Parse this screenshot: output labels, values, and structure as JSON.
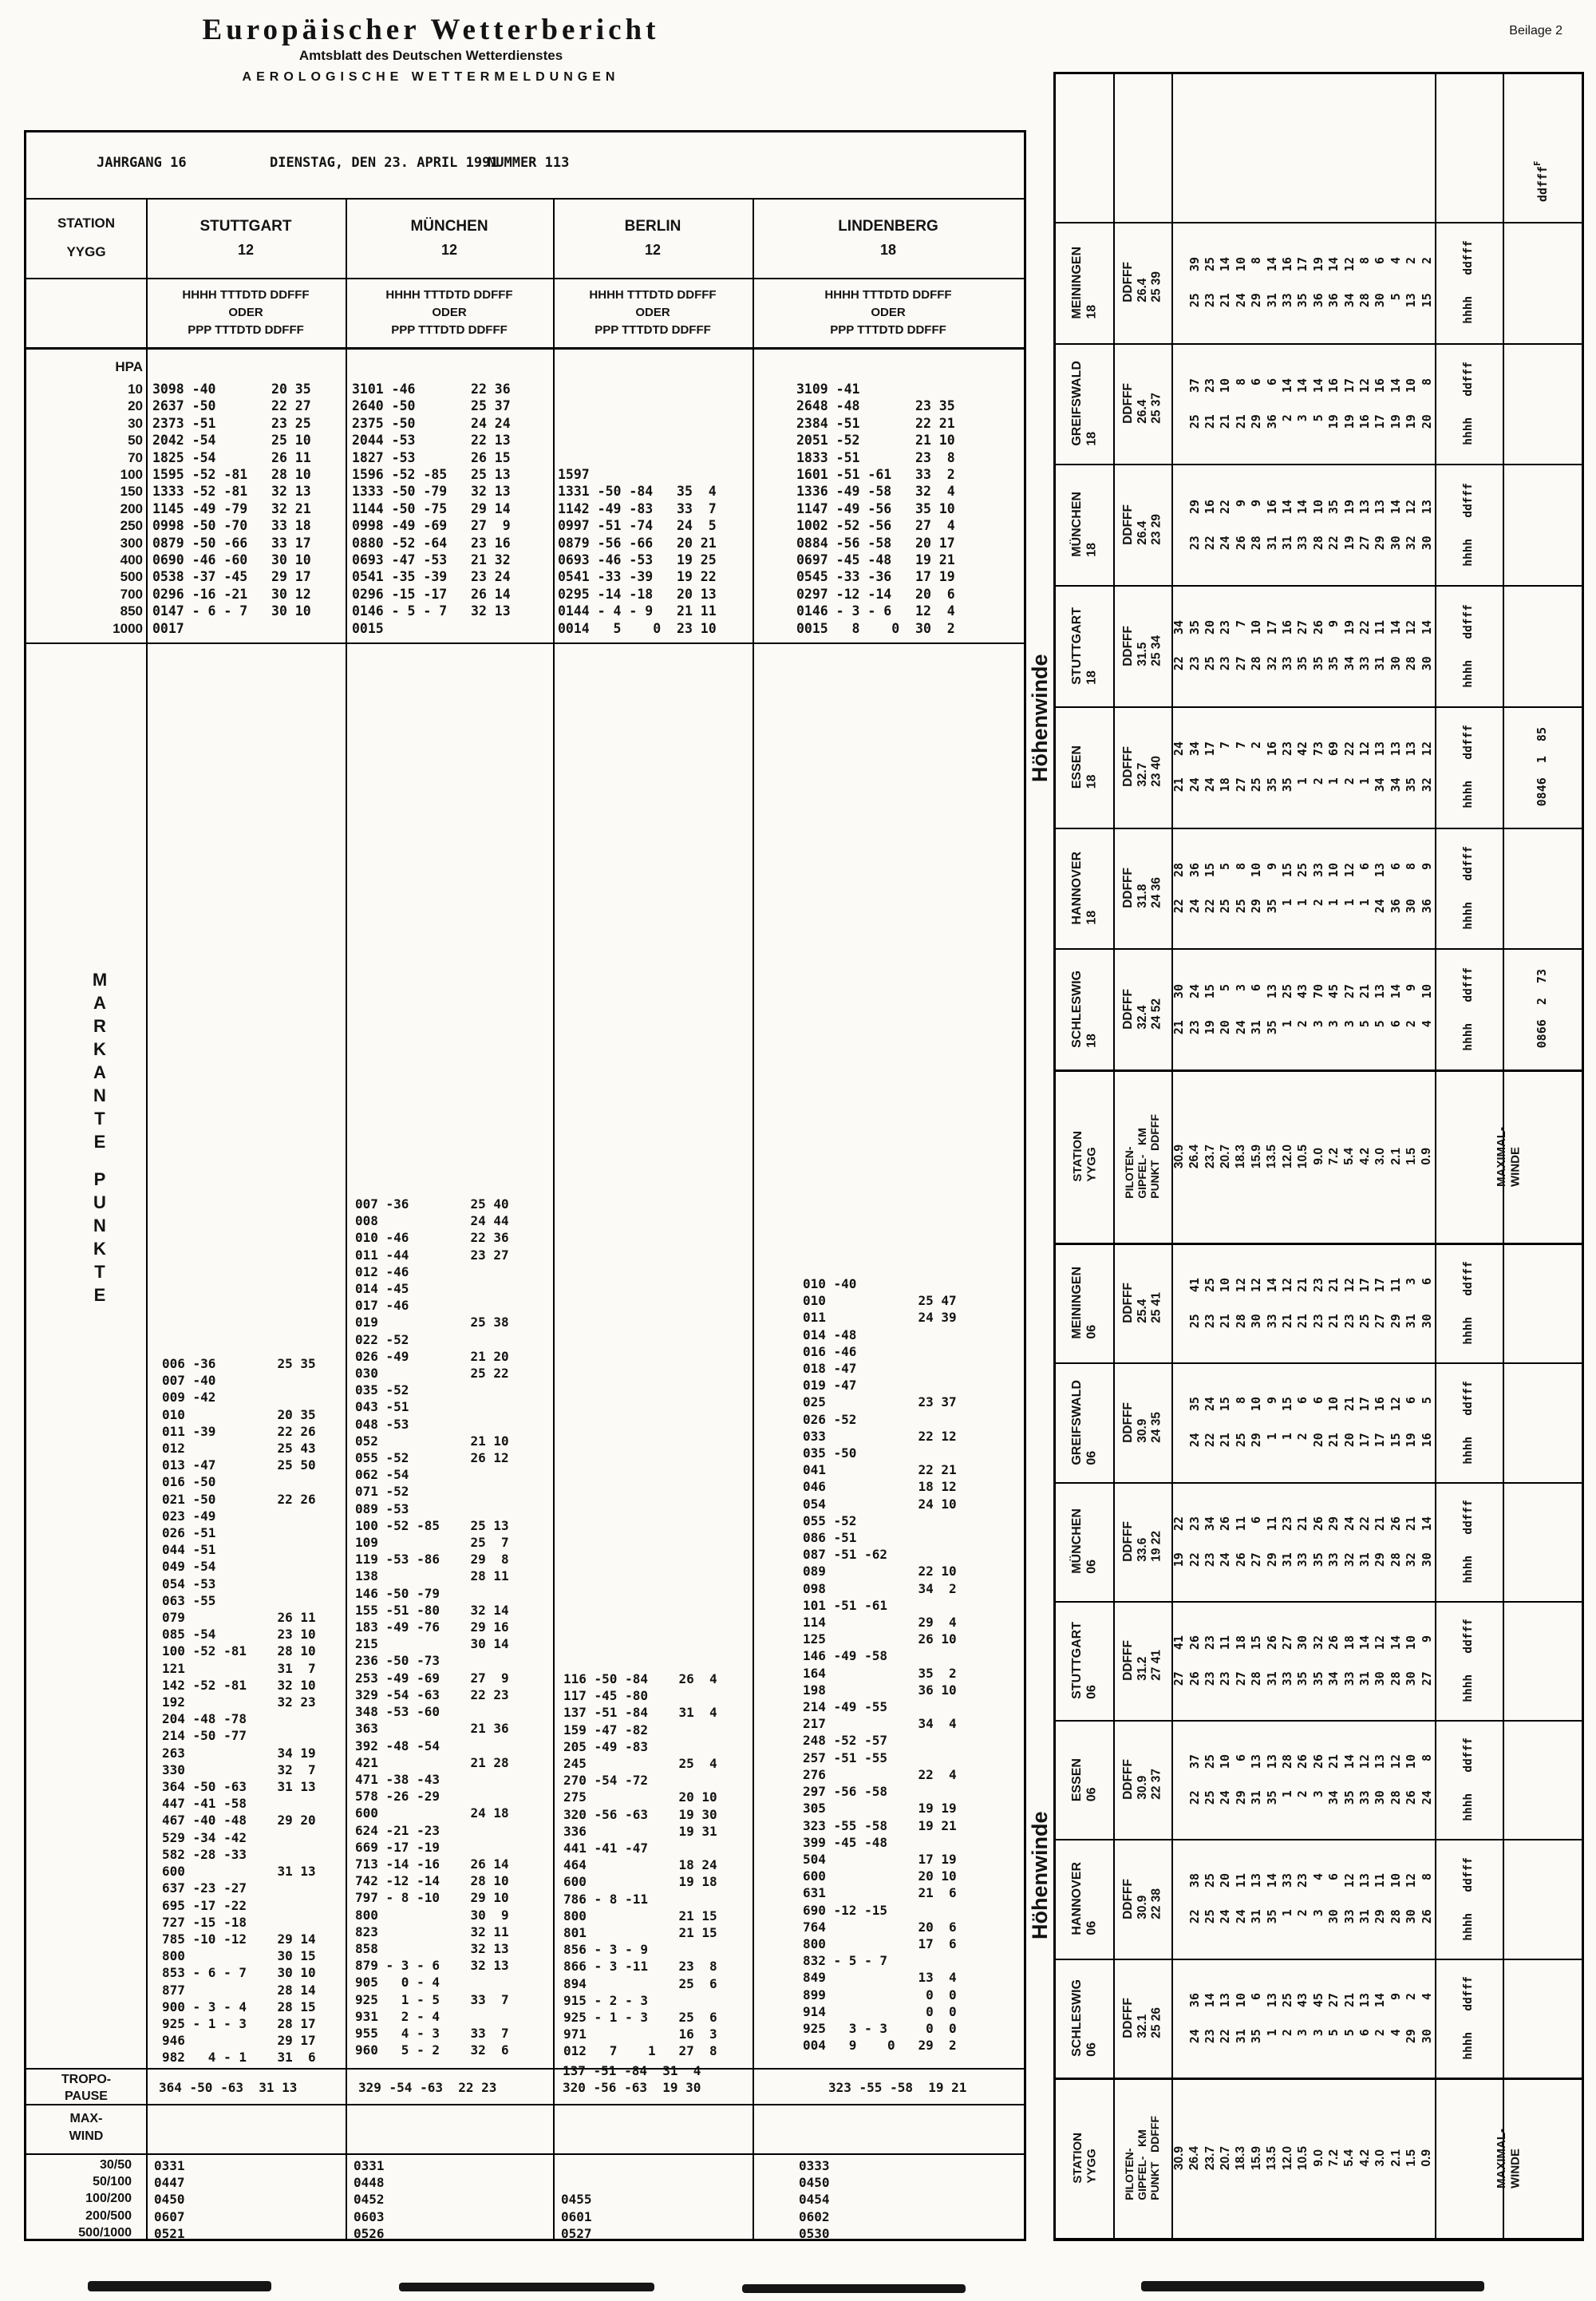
{
  "page": {
    "title": "Europäischer Wetterbericht",
    "subtitle": "Amtsblatt des Deutschen Wetterdienstes",
    "section": "AEROLOGISCHE WETTERMELDUNGEN",
    "corner": "Beilage 2"
  },
  "info": {
    "jahrgang": "JAHRGANG 16",
    "datum": "DIENSTAG, DEN 23. APRIL 1991",
    "nummer": "NUMMER 113"
  },
  "main_table": {
    "label_header": {
      "station": "STATION",
      "yygg": "YYGG",
      "hpa": "HPA"
    },
    "col_header": [
      "HHHH  TTTDTD  DDFFF",
      "ODER",
      "PPP  TTTDTD  DDFFF"
    ],
    "pressures": [
      "10",
      "20",
      "30",
      "50",
      "70",
      "100",
      "150",
      "200",
      "250",
      "300",
      "400",
      "500",
      "700",
      "850",
      "1000"
    ],
    "markante_label": "MARKANTE PUNKTE",
    "tropo_label": [
      "TROPO-",
      "PAUSE"
    ],
    "maxwind_label": [
      "MAX-",
      "WIND"
    ],
    "maxwind_rows": [
      "30/50",
      "50/100",
      "100/200",
      "200/500",
      "500/1000"
    ],
    "stations": [
      {
        "name": "STUTTGART",
        "yygg": "12",
        "hpa_rows": [
          "3098 -40       20 35",
          "2637 -50       22 27",
          "2373 -51       23 25",
          "2042 -54       25 10",
          "1825 -54       26 11",
          "1595 -52 -81   28 10",
          "1333 -52 -81   32 13",
          "1145 -49 -79   32 21",
          "0998 -50 -70   33 18",
          "0879 -50 -66   33 17",
          "0690 -46 -60   30 10",
          "0538 -37 -45   29 17",
          "0296 -16 -21   30 12",
          "0147 - 6 - 7   30 10",
          "0017"
        ],
        "markante": [
          "006 -36        25 35",
          "007 -40",
          "009 -42",
          "010            20 35",
          "011 -39        22 26",
          "012            25 43",
          "013 -47        25 50",
          "016 -50",
          "021 -50        22 26",
          "023 -49",
          "026 -51",
          "044 -51",
          "049 -54",
          "054 -53",
          "063 -55",
          "079            26 11",
          "085 -54        23 10",
          "100 -52 -81    28 10",
          "121            31  7",
          "142 -52 -81    32 10",
          "192            32 23",
          "204 -48 -78",
          "214 -50 -77",
          "263            34 19",
          "330            32  7",
          "364 -50 -63    31 13",
          "447 -41 -58",
          "467 -40 -48    29 20",
          "529 -34 -42",
          "582 -28 -33",
          "600            31 13",
          "637 -23 -27",
          "695 -17 -22",
          "727 -15 -18",
          "785 -10 -12    29 14",
          "800            30 15",
          "853 - 6 - 7    30 10",
          "877            28 14",
          "900 - 3 - 4    28 15",
          "925 - 1 - 3    28 17",
          "946            29 17",
          "982   4 - 1    31  6"
        ],
        "tropopause": [
          "364 -50 -63  31 13"
        ],
        "maxwind": [
          "0331",
          "0447",
          "0450",
          "0607",
          "0521"
        ]
      },
      {
        "name": "MÜNCHEN",
        "yygg": "12",
        "hpa_rows": [
          "3101 -46       22 36",
          "2640 -50       25 37",
          "2375 -50       24 24",
          "2044 -53       22 13",
          "1827 -53       26 15",
          "1596 -52 -85   25 13",
          "1333 -50 -79   32 13",
          "1144 -50 -75   29 14",
          "0998 -49 -69   27  9",
          "0880 -52 -64   23 16",
          "0693 -47 -53   21 32",
          "0541 -35 -39   23 24",
          "0296 -15 -17   26 14",
          "0146 - 5 - 7   32 13",
          "0015"
        ],
        "markante": [
          "007 -36        25 40",
          "008            24 44",
          "010 -46        22 36",
          "011 -44        23 27",
          "012 -46",
          "014 -45",
          "017 -46",
          "019            25 38",
          "022 -52",
          "026 -49        21 20",
          "030            25 22",
          "035 -52",
          "043 -51",
          "048 -53",
          "052            21 10",
          "055 -52        26 12",
          "062 -54",
          "071 -52",
          "089 -53",
          "100 -52 -85    25 13",
          "109            25  7",
          "119 -53 -86    29  8",
          "138            28 11",
          "146 -50 -79",
          "155 -51 -80    32 14",
          "183 -49 -76    29 16",
          "215            30 14",
          "236 -50 -73",
          "253 -49 -69    27  9",
          "329 -54 -63    22 23",
          "348 -53 -60",
          "363            21 36",
          "392 -48 -54",
          "421            21 28",
          "471 -38 -43",
          "578 -26 -29",
          "600            24 18",
          "624 -21 -23",
          "669 -17 -19",
          "713 -14 -16    26 14",
          "742 -12 -14    28 10",
          "797 - 8 -10    29 10",
          "800            30  9",
          "823            32 11",
          "858            32 13",
          "879 - 3 - 6    32 13",
          "905   0 - 4",
          "925   1 - 5    33  7",
          "931   2 - 4",
          "955   4 - 3    33  7",
          "960   5 - 2    32  6"
        ],
        "tropopause": [
          "329 -54 -63  22 23"
        ],
        "maxwind": [
          "0331",
          "0448",
          "0452",
          "0603",
          "0526"
        ]
      },
      {
        "name": "BERLIN",
        "yygg": "12",
        "hpa_rows": [
          "",
          "",
          "",
          "",
          "",
          "1597",
          "1331 -50 -84   35  4",
          "1142 -49 -83   33  7",
          "0997 -51 -74   24  5",
          "0879 -56 -66   20 21",
          "0693 -46 -53   19 25",
          "0541 -33 -39   19 22",
          "0295 -14 -18   20 13",
          "0144 - 4 - 9   21 11",
          "0014   5    0  23 10"
        ],
        "markante": [
          "116 -50 -84    26  4",
          "117 -45 -80",
          "137 -51 -84    31  4",
          "159 -47 -82",
          "205 -49 -83",
          "245            25  4",
          "270 -54 -72",
          "275            20 10",
          "320 -56 -63    19 30",
          "336            19 31",
          "441 -41 -47",
          "464            18 24",
          "600            19 18",
          "786 - 8 -11",
          "800            21 15",
          "801            21 15",
          "856 - 3 - 9",
          "866 - 3 -11    23  8",
          "894            25  6",
          "915 - 2 - 3",
          "925 - 1 - 3    25  6",
          "971            16  3",
          "012   7    1   27  8"
        ],
        "tropopause": [
          "137 -51 -84  31  4",
          "320 -56 -63  19 30"
        ],
        "maxwind": [
          "",
          "",
          "0455",
          "0601",
          "0527"
        ]
      },
      {
        "name": "LINDENBERG",
        "yygg": "18",
        "hpa_rows": [
          "3109 -41",
          "2648 -48       23 35",
          "2384 -51       22 21",
          "2051 -52       21 10",
          "1833 -51       23  8",
          "1601 -51 -61   33  2",
          "1336 -49 -58   32  4",
          "1147 -49 -56   35 10",
          "1002 -52 -56   27  4",
          "0884 -56 -58   20 17",
          "0697 -45 -48   19 21",
          "0545 -33 -36   17 19",
          "0297 -12 -14   20  6",
          "0146 - 3 - 6   12  4",
          "0015   8    0  30  2"
        ],
        "markante": [
          "010 -40",
          "010            25 47",
          "011            24 39",
          "014 -48",
          "016 -46",
          "018 -47",
          "019 -47",
          "025            23 37",
          "026 -52",
          "033            22 12",
          "035 -50",
          "041            22 21",
          "046            18 12",
          "054            24 10",
          "055 -52",
          "086 -51",
          "087 -51 -62",
          "089            22 10",
          "098            34  2",
          "101 -51 -61",
          "114            29  4",
          "125            26 10",
          "146 -49 -58",
          "164            35  2",
          "198            36 10",
          "214 -49 -55",
          "217            34  4",
          "248 -52 -57",
          "257 -51 -55",
          "276            22  4",
          "297 -56 -58",
          "305            19 19",
          "323 -55 -58    19 21",
          "399 -45 -48",
          "504            17 19",
          "600            20 10",
          "631            21  6",
          "690 -12 -15",
          "764            20  6",
          "800            17  6",
          "832 - 5 - 7",
          "849            13  4",
          "899             0  0",
          "914             0  0",
          "925   3 - 3     0  0",
          "004   9    0   29  2"
        ],
        "tropopause": [
          "323 -55 -58  19 21"
        ],
        "maxwind": [
          "0333",
          "0450",
          "0454",
          "0602",
          "0530"
        ]
      }
    ]
  },
  "right_panel": {
    "hoehenwinde_label": "Höhenwinde",
    "corner_label": "ddfff",
    "corner_super": "F",
    "col_labels": "hhhh   ddfff",
    "ddfff_label": "DDFFF",
    "header": {
      "station_lines": [
        "STATION",
        "YYGG"
      ],
      "piloten_lines": [
        "PILOTEN-",
        "GIPFEL-   KM",
        "PUNKT   DDFFF"
      ],
      "maximal_lines": [
        "MAXIMAL-",
        "WINDE"
      ]
    },
    "km_values": [
      "30.9",
      "26.4",
      "23.7",
      "20.7",
      "18.3",
      "15.9",
      "13.5",
      "12.0",
      "10.5",
      "9.0",
      "7.2",
      "5.4",
      "4.2",
      "3.0",
      "2.1",
      "1.5",
      "0.9"
    ],
    "sections": [
      {
        "id": "18",
        "stations": [
          {
            "name": "MEININGEN",
            "yygg": "18",
            "gipfel": "26.4",
            "maxw": "25 39",
            "annotation": "",
            "pairs": [
              "",
              "25   39",
              "23   25",
              "21   14",
              "24   10",
              "29    8",
              "31   14",
              "33   16",
              "35   17",
              "36   19",
              "36   14",
              "34   12",
              "28    8",
              "30    6",
              " 5    4",
              "13    2",
              "15    2"
            ]
          },
          {
            "name": "GREIFSWALD",
            "yygg": "18",
            "gipfel": "26.4",
            "maxw": "25 37",
            "annotation": "",
            "pairs": [
              "",
              "25   37",
              "21   23",
              "21   10",
              "21    8",
              "29    6",
              "36    6",
              " 2   14",
              " 3   14",
              " 5   14",
              "19   16",
              "19   17",
              "16   12",
              "17   16",
              "19   14",
              "19   10",
              "20    8"
            ]
          },
          {
            "name": "MÜNCHEN",
            "yygg": "18",
            "gipfel": "26.4",
            "maxw": "23 29",
            "annotation": "",
            "pairs": [
              "",
              "23   29",
              "22   16",
              "24   22",
              "26    9",
              "28    9",
              "31   16",
              "31   14",
              "33   14",
              "28   10",
              "22   35",
              "19   19",
              "27   13",
              "29   13",
              "30   14",
              "32   12",
              "30   13"
            ]
          },
          {
            "name": "STUTTGART",
            "yygg": "18",
            "gipfel": "31.5",
            "maxw": "25 34",
            "annotation": "",
            "pairs": [
              "22   34",
              "23   35",
              "25   20",
              "23   23",
              "27    7",
              "28   10",
              "32   17",
              "33   16",
              "35   27",
              "35   26",
              "35    9",
              "34   19",
              "33   22",
              "31   11",
              "30   14",
              "28   12",
              "30   14"
            ]
          },
          {
            "name": "ESSEN",
            "yygg": "18",
            "gipfel": "32.7",
            "maxw": "23 40",
            "annotation": "0846  1  85",
            "pairs": [
              "21   24",
              "24   34",
              "24   17",
              "18    7",
              "27    7",
              "25    2",
              "35   16",
              "35   23",
              " 1   42",
              " 2   73",
              " 1   69",
              " 2   22",
              " 1   12",
              "34   13",
              "34   13",
              "35   13",
              "32   12"
            ]
          },
          {
            "name": "HANNOVER",
            "yygg": "18",
            "gipfel": "31.8",
            "maxw": "24 36",
            "annotation": "",
            "pairs": [
              "22   28",
              "24   36",
              "22   15",
              "25    5",
              "25    8",
              "29   10",
              "35    9",
              " 1   15",
              " 1   25",
              " 2   33",
              " 1   10",
              " 1   12",
              " 1    6",
              "24   13",
              "36    6",
              "30    8",
              "36    9"
            ]
          },
          {
            "name": "SCHLESWIG",
            "yygg": "18",
            "gipfel": "32.4",
            "maxw": "24 52",
            "annotation": "0866  2  73",
            "pairs": [
              "21   30",
              "23   24",
              "19   15",
              "20    5",
              "24    3",
              "31    6",
              "35   13",
              " 1   25",
              " 2   43",
              " 3   70",
              " 3   45",
              " 3   27",
              " 5   21",
              " 5   13",
              " 6   14",
              " 2    9",
              " 4   10"
            ]
          }
        ]
      },
      {
        "id": "06",
        "stations": [
          {
            "name": "MEININGEN",
            "yygg": "06",
            "gipfel": "25.4",
            "maxw": "25 41",
            "annotation": "",
            "pairs": [
              "",
              "25   41",
              "23   25",
              "21   10",
              "28   12",
              "30   12",
              "33   14",
              "21   12",
              "21   21",
              "23   23",
              "21   21",
              "23   12",
              "25   17",
              "27   17",
              "29   11",
              "31    3",
              "30    6"
            ]
          },
          {
            "name": "GREIFSWALD",
            "yygg": "06",
            "gipfel": "30.9",
            "maxw": "24 35",
            "annotation": "",
            "pairs": [
              "",
              "24   35",
              "22   24",
              "21   15",
              "25    8",
              "29   10",
              " 1    9",
              " 1   15",
              " 2    6",
              "20    6",
              "21   10",
              "20   21",
              "17   17",
              "17   16",
              "15   12",
              "19    6",
              "16    5"
            ]
          },
          {
            "name": "MÜNCHEN",
            "yygg": "06",
            "gipfel": "33.6",
            "maxw": "19 22",
            "annotation": "",
            "pairs": [
              "19   22",
              "22   23",
              "23   34",
              "24   26",
              "26   11",
              "27    6",
              "29   11",
              "31   23",
              "33   21",
              "35   26",
              "33   29",
              "32   24",
              "31   22",
              "29   21",
              "28   26",
              "32   21",
              "30   14"
            ]
          },
          {
            "name": "STUTTGART",
            "yygg": "06",
            "gipfel": "31.2",
            "maxw": "27 41",
            "annotation": "",
            "pairs": [
              "27   41",
              "26   26",
              "23   23",
              "23   11",
              "27   18",
              "28   15",
              "31   26",
              "33   27",
              "35   30",
              "35   32",
              "34   26",
              "33   18",
              "31   14",
              "30   12",
              "28   14",
              "30   10",
              "27    9"
            ]
          },
          {
            "name": "ESSEN",
            "yygg": "06",
            "gipfel": "30.9",
            "maxw": "22 37",
            "annotation": "",
            "pairs": [
              "",
              "22   37",
              "25   25",
              "24   10",
              "29    6",
              "31   13",
              "35   13",
              " 1   28",
              " 2   26",
              " 3   26",
              "34   21",
              "35   14",
              "33   12",
              "30   13",
              "28   12",
              "26   10",
              "24    8"
            ]
          },
          {
            "name": "HANNOVER",
            "yygg": "06",
            "gipfel": "30.9",
            "maxw": "22 38",
            "annotation": "",
            "pairs": [
              "",
              "22   38",
              "25   25",
              "24   20",
              "24   11",
              "31   13",
              "35   14",
              " 1   33",
              " 2   23",
              " 3    4",
              "30    6",
              "33   12",
              "31   13",
              "29   11",
              "28   10",
              "30   12",
              "26    8"
            ]
          },
          {
            "name": "SCHLESWIG",
            "yygg": "06",
            "gipfel": "32.1",
            "maxw": "25 26",
            "annotation": "",
            "pairs": [
              "",
              "24   36",
              "23   14",
              "22   13",
              "31   10",
              "35    6",
              " 1   13",
              " 2   25",
              " 3   43",
              " 3   45",
              " 5   27",
              " 5   21",
              " 6   13",
              " 2   14",
              " 4    9",
              "29    2",
              "30    4"
            ]
          }
        ]
      }
    ]
  }
}
